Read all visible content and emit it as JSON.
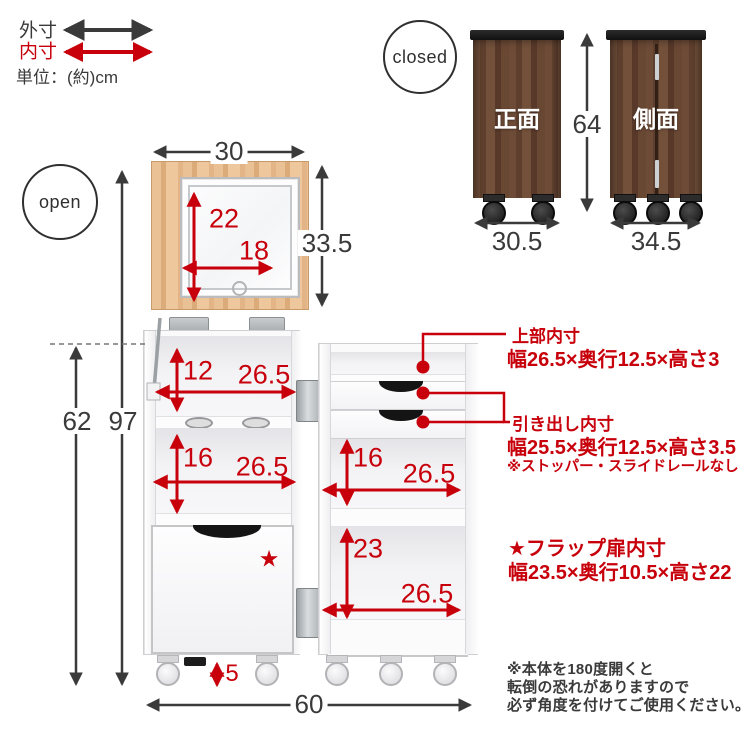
{
  "colors": {
    "accent_red": "#c7000b",
    "text_dark": "#3a3a3a",
    "wood_dark": "#654531",
    "wood_light": "#e5ba8c"
  },
  "legend": {
    "outer": "外寸",
    "inner": "内寸",
    "unit": "単位：(約)cm"
  },
  "closed": {
    "badge": "closed",
    "front_label": "正面",
    "side_label": "側面",
    "height": "64",
    "front_width": "30.5",
    "side_width": "34.5"
  },
  "open": {
    "badge": "open",
    "star": "★"
  },
  "dims": {
    "panel_w": "30",
    "panel_h": "33.5",
    "mirror_h": "22",
    "mirror_w": "18",
    "lu_top_h": "12",
    "lu_top_w": "26.5",
    "lu_mid_h": "16",
    "lu_mid_w": "26.5",
    "ru_shelf_h": "16",
    "ru_shelf_w": "26.5",
    "ru_bot_h": "23",
    "ru_bot_w": "26.5",
    "body_h": "62",
    "total_h": "97",
    "caster_h": "5",
    "total_w": "60"
  },
  "callouts": {
    "top_inner_title": "上部内寸",
    "top_inner_dims": "幅26.5×奥行12.5×高さ3",
    "drawer_title": "引き出し内寸",
    "drawer_dims": "幅25.5×奥行12.5×高さ3.5",
    "drawer_note": "※ストッパー・スライドレールなし",
    "flap_title": "★フラップ扉内寸",
    "flap_dims": "幅23.5×奥行10.5×高さ22"
  },
  "caution": {
    "line1": "※本体を180度開くと",
    "line2": "転倒の恐れがありますので",
    "line3": "必ず角度を付けてご使用ください。"
  }
}
